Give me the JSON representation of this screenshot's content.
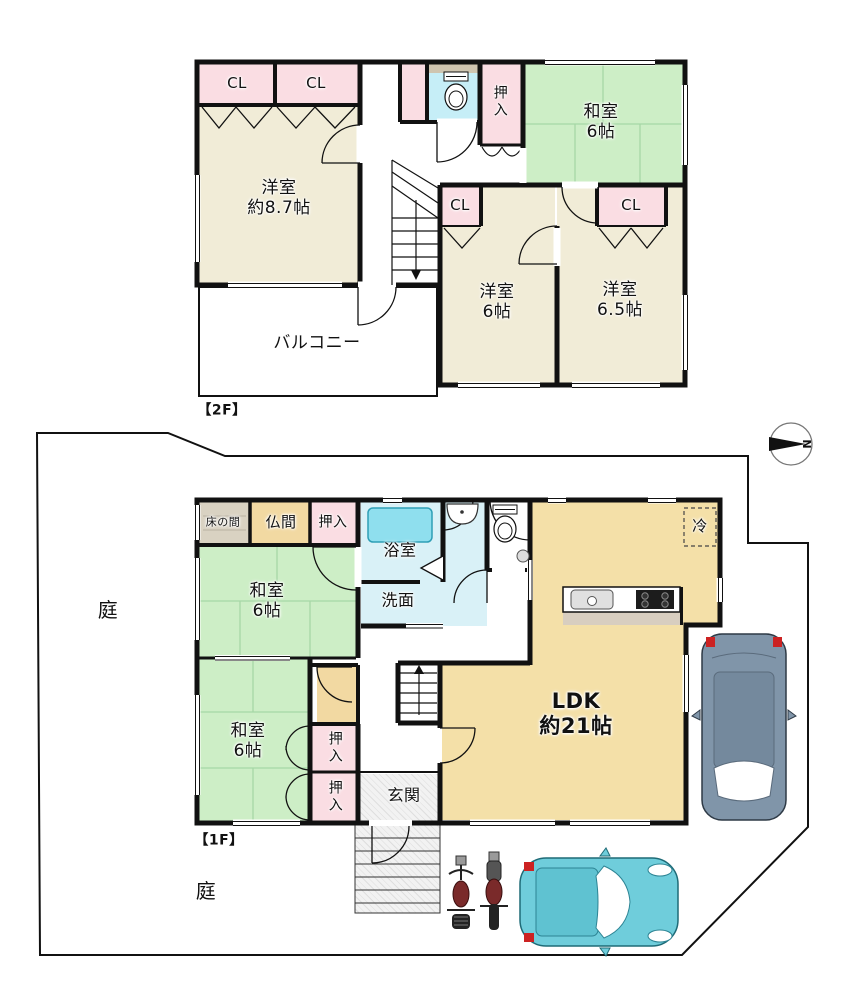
{
  "site": {
    "garden_left": "庭",
    "garden_bottom": "庭"
  },
  "floor2": {
    "floor_tag": "【2F】",
    "closet1": "CL",
    "closet2": "CL",
    "closet3": "CL",
    "closet4": "CL",
    "western_room_87": "洋室\n約8.7帖",
    "oshiire": "押\n入",
    "japanese_room": "和室\n6帖",
    "western_room_6": "洋室\n6帖",
    "western_room_65": "洋室\n6.5帖",
    "balcony": "バルコニー"
  },
  "floor1": {
    "floor_tag": "【1F】",
    "tokonoma": "床の間",
    "butsuma": "仏間",
    "oshiire_top": "押入",
    "japanese_room_1": "和室\n6帖",
    "bathroom": "浴室",
    "washroom": "洗面",
    "refrigerator": "冷",
    "ldk": "LDK\n約21帖",
    "japanese_room_2": "和室\n6帖",
    "oshiire_a": "押\n入",
    "oshiire_b": "押\n入",
    "entrance": "玄関"
  },
  "compass": {
    "north": "N"
  },
  "colors": {
    "wall": "#111111",
    "tatami_green": "#cdeec6",
    "tatami_line": "#a6d7a6",
    "cream_room": "#f1ecd7",
    "ldk_yellow": "#f4e0a8",
    "closet_pink": "#fadde3",
    "wet_area_blue": "#d9f1f7",
    "bathtub_cyan": "#8fdfee",
    "toilet_floor_blue": "#c6eef7",
    "altar_tan": "#f2d9a2",
    "tokonoma_gray": "#d9d2c2",
    "counter_shadow": "#d8cec0",
    "car_teal": "#6fcddb",
    "car_gray": "#8095a9",
    "accent_red": "#cc2222"
  }
}
